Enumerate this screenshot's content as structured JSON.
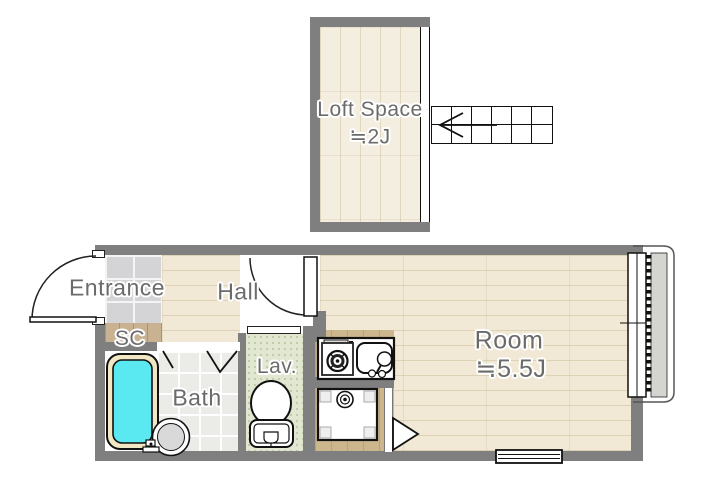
{
  "rooms": {
    "loft": {
      "label": "Loft Space",
      "size": "≒2J"
    },
    "entrance": {
      "label": "Entrance"
    },
    "shoe_closet": {
      "label": "SC"
    },
    "hall": {
      "label": "Hall"
    },
    "bath": {
      "label": "Bath"
    },
    "lavatory": {
      "label": "Lav."
    },
    "main_room": {
      "label": "Room",
      "size": "≒5.5J"
    }
  },
  "features": {
    "icons": [
      "staircase-icon",
      "ladder-opening-icon",
      "entrance-door-icon",
      "hall-door-icon",
      "folding-bath-door-icon",
      "sliding-lav-door-icon",
      "kitchen-door-icon",
      "bathtub-icon",
      "bath-stool-icon",
      "bath-faucet-icon",
      "toilet-icon",
      "gas-stove-icon",
      "kitchen-sink-icon",
      "washing-machine-pan-icon",
      "sliding-window-icon",
      "low-window-icon",
      "balcony-icon",
      "direction-arrow-icon"
    ]
  },
  "colors": {
    "wall": "#7f7f7f",
    "wood_floor": "#f1e9d5",
    "loft_floor": "#f4eee0",
    "entrance_tile": "#d4d4d6",
    "sc_wood": "#c8b292",
    "kitchen_floor": "#ccb68e",
    "lav_floor": "#e1e7d1",
    "bath_tile": "#ebebe7",
    "bathtub_water": "#5ae9f1",
    "bathtub_rim": "#f1e7c5",
    "balcony_concrete": "#d4d4d0",
    "label_text": "#6b6b6b"
  }
}
